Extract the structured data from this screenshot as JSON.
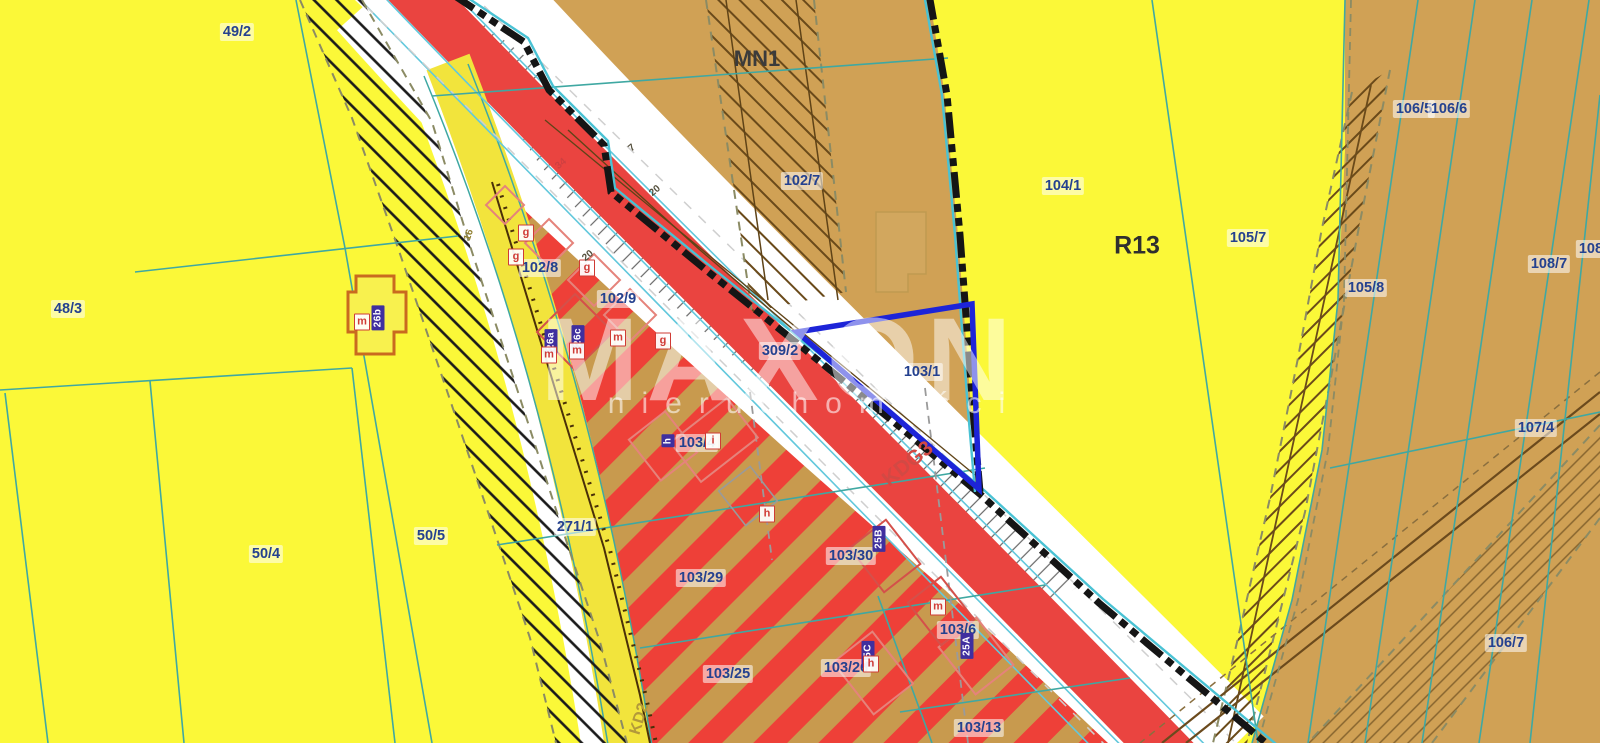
{
  "watermark": {
    "brand": "MAXON",
    "subtitle": "nieruchomości"
  },
  "selected_parcel": {
    "id": "103/1",
    "outline_color": "#1d24d8"
  },
  "palette": {
    "yellow_zone": "#fbf838",
    "tan_zone": "#d0a155",
    "stripe_red": "#ee4038",
    "road_red": "#ea4440",
    "road_yellow": "#f2e43c",
    "cadastral_teal": "#3fa8a2",
    "parcel_label_blue": "#24418f",
    "plan_boundary_black": "#151515"
  },
  "zone_labels": [
    {
      "code": "MN1",
      "x": 757,
      "y": 59,
      "size": 22,
      "color": "#3b3b3b",
      "rot": 0
    },
    {
      "code": "R13",
      "x": 1137,
      "y": 246,
      "size": 25,
      "color": "#2f2f2f",
      "rot": 0
    },
    {
      "code": "KDG3",
      "x": 908,
      "y": 464,
      "size": 21,
      "color": "#d24944",
      "rot": -39
    },
    {
      "code": "KD2",
      "x": 640,
      "y": 719,
      "size": 16,
      "color": "#b3993a",
      "rot": -73
    }
  ],
  "parcel_labels": [
    {
      "id": "49/2",
      "x": 237,
      "y": 32
    },
    {
      "id": "48/3",
      "x": 68,
      "y": 309
    },
    {
      "id": "50/4",
      "x": 266,
      "y": 554
    },
    {
      "id": "50/5",
      "x": 431,
      "y": 536
    },
    {
      "id": "271/1",
      "x": 575,
      "y": 527
    },
    {
      "id": "102/8",
      "x": 540,
      "y": 268
    },
    {
      "id": "102/9",
      "x": 618,
      "y": 299
    },
    {
      "id": "102/7",
      "x": 802,
      "y": 181
    },
    {
      "id": "309/2",
      "x": 780,
      "y": 351
    },
    {
      "id": "103/1",
      "x": 922,
      "y": 372
    },
    {
      "id": "104/1",
      "x": 1063,
      "y": 186
    },
    {
      "id": "105/7",
      "x": 1248,
      "y": 238
    },
    {
      "id": "105/8",
      "x": 1366,
      "y": 288
    },
    {
      "id": "106/5",
      "x": 1414,
      "y": 109
    },
    {
      "id": "106/6",
      "x": 1449,
      "y": 109
    },
    {
      "id": "108/7",
      "x": 1549,
      "y": 264
    },
    {
      "id": "108/8",
      "x": 1597,
      "y": 249
    },
    {
      "id": "107/4",
      "x": 1536,
      "y": 428
    },
    {
      "id": "106/7",
      "x": 1506,
      "y": 643
    },
    {
      "id": "103/4",
      "x": 697,
      "y": 443
    },
    {
      "id": "103/29",
      "x": 701,
      "y": 578
    },
    {
      "id": "103/30",
      "x": 851,
      "y": 556
    },
    {
      "id": "103/25",
      "x": 728,
      "y": 674
    },
    {
      "id": "103/26",
      "x": 846,
      "y": 668
    },
    {
      "id": "103/6",
      "x": 958,
      "y": 630
    },
    {
      "id": "103/13",
      "x": 979,
      "y": 728
    }
  ],
  "marker_chips": [
    {
      "text": "26b",
      "type": "purple",
      "x": 378,
      "y": 318
    },
    {
      "text": "26a",
      "type": "purple",
      "x": 551,
      "y": 341
    },
    {
      "text": "26c",
      "type": "purple",
      "x": 578,
      "y": 337
    },
    {
      "text": "25B",
      "type": "purple",
      "x": 879,
      "y": 539
    },
    {
      "text": "25A",
      "type": "purple",
      "x": 967,
      "y": 646
    },
    {
      "text": "15C",
      "type": "purple",
      "x": 868,
      "y": 654
    },
    {
      "text": "h",
      "type": "purple",
      "x": 668,
      "y": 441
    },
    {
      "text": "m",
      "type": "letter",
      "x": 362,
      "y": 322
    },
    {
      "text": "m",
      "type": "letter",
      "x": 549,
      "y": 355
    },
    {
      "text": "m",
      "type": "letter",
      "x": 577,
      "y": 351
    },
    {
      "text": "m",
      "type": "letter",
      "x": 618,
      "y": 338
    },
    {
      "text": "m",
      "type": "letter",
      "x": 938,
      "y": 607
    },
    {
      "text": "g",
      "type": "letter",
      "x": 526,
      "y": 233
    },
    {
      "text": "g",
      "type": "letter",
      "x": 516,
      "y": 257
    },
    {
      "text": "g",
      "type": "letter",
      "x": 587,
      "y": 268
    },
    {
      "text": "g",
      "type": "letter",
      "x": 663,
      "y": 341
    },
    {
      "text": "h",
      "type": "letter",
      "x": 767,
      "y": 514
    },
    {
      "text": "h",
      "type": "letter",
      "x": 871,
      "y": 664
    },
    {
      "text": "i",
      "type": "letter",
      "x": 713,
      "y": 441
    }
  ],
  "dimension_labels": [
    {
      "text": "34",
      "x": 561,
      "y": 164,
      "rot": -40,
      "color": "#cf4040"
    },
    {
      "text": "20",
      "x": 655,
      "y": 191,
      "rot": -40,
      "color": "#55503d"
    },
    {
      "text": "20",
      "x": 588,
      "y": 256,
      "rot": -40,
      "color": "#55503d"
    },
    {
      "text": "16",
      "x": 469,
      "y": 235,
      "rot": -72,
      "color": "#8f7e2e"
    },
    {
      "text": "7",
      "x": 632,
      "y": 148,
      "rot": -40,
      "color": "#55503d"
    }
  ]
}
